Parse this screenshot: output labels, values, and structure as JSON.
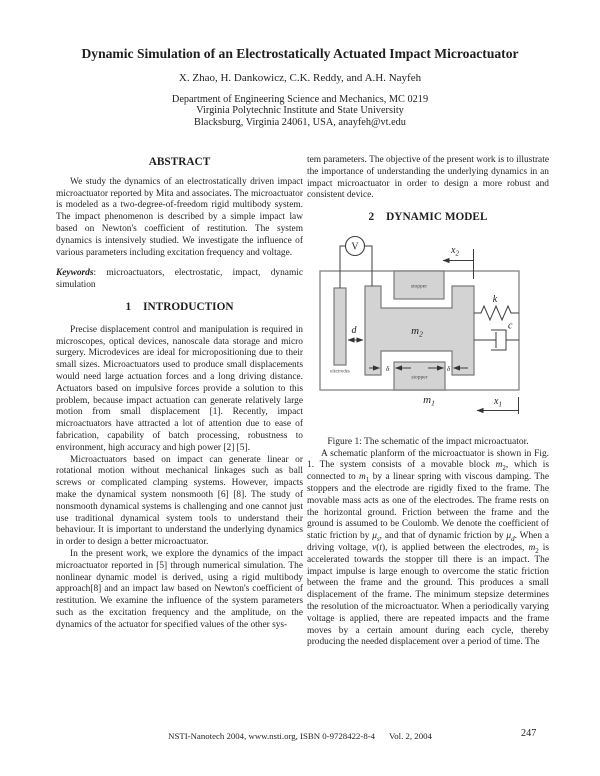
{
  "colors": {
    "figure_fill": "#d3d3d3",
    "figure_stroke": "#7a7a7a"
  },
  "header": {
    "title": "Dynamic Simulation of an Electrostatically Actuated Impact Microactuator",
    "authors": "X. Zhao, H. Dankowicz, C.K. Reddy, and A.H. Nayfeh",
    "affiliation": [
      "Department of Engineering Science and Mechanics, MC 0219",
      "Virginia Polytechnic Institute and State University",
      "Blacksburg, Virginia 24061, USA, anayfeh@vt.edu"
    ]
  },
  "abstract": {
    "heading": "ABSTRACT",
    "body": "We study the dynamics of an electrostatically driven impact microactuator reported by Mita and associates. The microactuator is modeled as a two-degree-of-freedom rigid multibody system. The impact phenomenon is described by a simple impact law based on Newton's coefficient of restitution. The system dynamics is intensively studied. We investigate the influence of various parameters including excitation frequency and voltage.",
    "keywords_label": "Keywords",
    "keywords": ": microactuators, electrostatic, impact, dynamic simulation"
  },
  "introduction": {
    "number": "1",
    "heading": "INTRODUCTION",
    "paragraphs": [
      "Precise displacement control and manipulation is required in microscopes, optical devices, nanoscale data storage and micro surgery. Microdevices are ideal for micropositioning due to their small sizes. Microactuators used to produce small displacements would need large actuation forces and a long driving distance. Actuators based on impulsive forces provide a solution to this problem, because impact actuation can generate relatively large motion from small displacement [1]. Recently, impact microactuators have attracted a lot of attention due to ease of fabrication, capability of batch processing, robustness to environment, high accuracy and high power [2] [5].",
      "Microactuators based on impact can generate linear or rotational motion without mechanical linkages such as ball screws or complicated clamping systems. However, impacts make the dynamical system nonsmooth [6] [8]. The study of nonsmooth dynamical systems is challenging and one cannot just use traditional dynamical system tools to understand their behaviour. It is important to understand the underlying dynamics in order to design a better microactuator.",
      "In the present work, we explore the dynamics of the impact microactuator reported in [5] through numerical simulation. The nonlinear dynamic model is derived, using a rigid multibody approach[8] and an impact law based on Newton's coefficient of restitution. We examine the influence of the system parameters such as the excitation frequency and the amplitude, on the dynamics of the actuator for specified values of the other sys-"
    ]
  },
  "dynamic_model": {
    "number": "2",
    "heading": "DYNAMIC MODEL",
    "continuation": "tem parameters. The objective of the present work is to illustrate the importance of understanding the underlying dynamics in an impact microactuator in order to design a more robust and consistent device.",
    "body": "A schematic planform of the microactuator is shown in Fig. 1. The system consists of a movable block <i>m</i><sub>2</sub>, which is connected to <i>m</i><sub>1</sub> by a linear spring with viscous damping. The stoppers and the electrode are rigidly fixed to the frame. The movable mass acts as one of the electrodes. The frame rests on the horizontal ground. Friction between the frame and the ground is assumed to be Coulomb. We denote the coefficient of static friction by <i>μ<sub>s</sub></i>, and that of dynamic friction by <i>μ<sub>d</sub></i>. When a driving voltage, <i>v</i>(<i>t</i>), is applied between the electrodes, <i>m</i><sub>2</sub> is accelerated towards the stopper till there is an impact. The impact impulse is large enough to overcome the static friction between the frame and the ground. This produces a small displacement of the frame. The minimum stepsize determines the resolution of the microactuator. When a periodically varying voltage is applied, there are repeated impacts and the frame moves by a certain amount during each cycle, thereby producing the needed displacement over a period of time. The"
  },
  "figure": {
    "caption": "Figure 1: The schematic of the impact microactuator.",
    "labels": {
      "voltage": "V",
      "x2_base": "x",
      "x2_sub": "2",
      "x1_base": "x",
      "x1_sub": "1",
      "m2_base": "m",
      "m2_sub": "2",
      "m1_base": "m",
      "m1_sub": "1",
      "k": "k",
      "c": "c",
      "d": "d",
      "delta_left": "δ",
      "delta_right": "δ",
      "stopper_top": "stopper",
      "stopper_bottom": "stopper",
      "electrodes": "electrodes"
    }
  },
  "footer": {
    "conference": "NSTI-Nanotech 2004, www.nsti.org, ISBN 0-9728422-8-4",
    "volume": "Vol. 2, 2004",
    "page_number": "247"
  }
}
